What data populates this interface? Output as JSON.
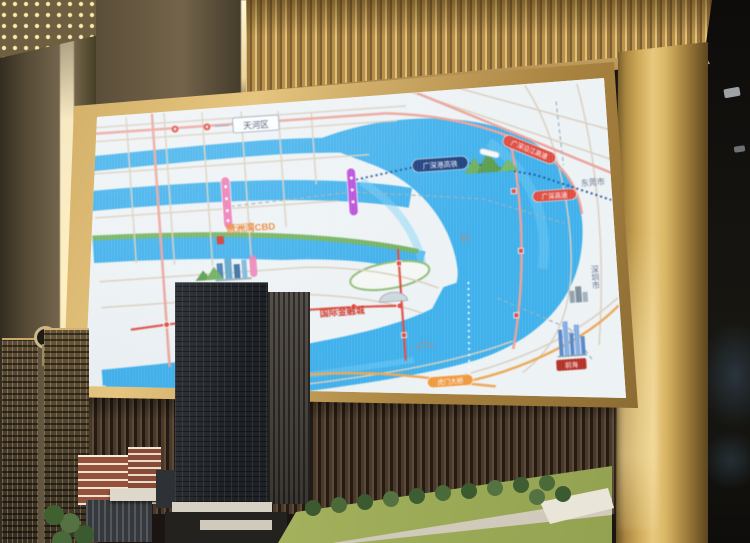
{
  "scene": {
    "description": "Sales-center showroom: gold-framed LED video wall showing a Pearl River estuary location map, architectural scale model in the foreground",
    "colors": {
      "frame_gold": "#caa45c",
      "valance_gold": "#c9a254",
      "ribbed_wall": "#49392a",
      "left_column": "#6e6049",
      "water_blue": "#45b0e8",
      "map_land": "#edf2f5",
      "greenway": "#76b164",
      "metro_pink": "#e87fb4",
      "metro_purple": "#b44fd4",
      "highway_red": "#d94f45",
      "bridge_orange": "#ec9a45",
      "rail_navy": "#1f3f7a",
      "lawn_green": "#9cab57",
      "model_tower": "#25282c",
      "brick_red": "#96503c"
    }
  },
  "map": {
    "district_label": "天河区",
    "city_ne": "东莞市",
    "city_se": "深圳市",
    "cbd_orange": "琶洲湾CBD",
    "finance_city": "国际金融城",
    "rail": "广深港高铁",
    "hwy_coastal": "广深沿江高速",
    "hwy_gs": "广深高速",
    "bridge_w": "南沙大桥",
    "bridge_e": "虎门大桥",
    "qianhai": "前海",
    "hotel": "H"
  }
}
